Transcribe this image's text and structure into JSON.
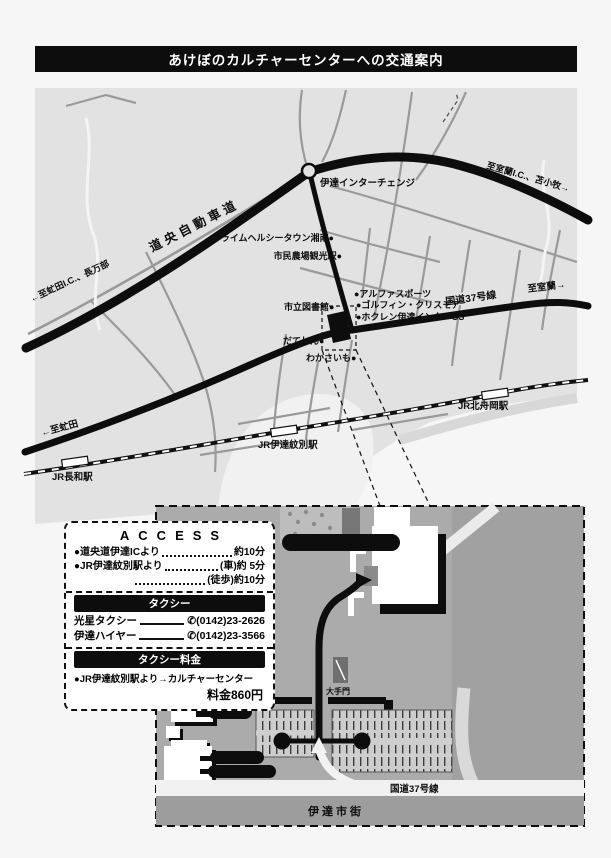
{
  "title": "あけぼのカルチャーセンターへの交通案内",
  "icons": {
    "phone": "✆",
    "parking": "P"
  },
  "map": {
    "expressway": "道央自動車道",
    "interchange": "伊達インターチェンジ",
    "to_muroran_ic": "至室蘭I.C.、苫小牧→",
    "to_abuta_ic": "←至虻田I.C.、長万部",
    "route37": "国道37号線",
    "to_muroran": "至室蘭→",
    "to_abuta": "←至虻田",
    "poi": {
      "prime_healthy_town": "プライムヘルシータウン湘南●",
      "shimin_station": "市民農場観光駅●",
      "alpha_sports": "●アルファスポーツ",
      "golfin_chrismore": "●ゴルフィン・クリスモア",
      "hokuren_gs": "●ホクレン伊達インターGS",
      "library": "市立図書館●",
      "dateshin": "だてしん●",
      "wakasaimo": "わかさいも●"
    },
    "stations": {
      "nagawa": "JR長和駅",
      "date_mombetsu": "JR伊達紋別駅",
      "kita_funaoka": "JR北舟岡駅"
    }
  },
  "access": {
    "title": "ACCESS",
    "rows": [
      {
        "label": "●道央道伊達ICより",
        "value": "約10分"
      },
      {
        "label": "●JR伊達紋別駅より",
        "value": "(車)約 5分"
      },
      {
        "label": "",
        "value": "(徒歩)約10分"
      }
    ],
    "taxi_header": "タクシー",
    "taxi_rows": [
      {
        "name": "光星タクシー",
        "phone": "(0142)23-2626"
      },
      {
        "name": "伊達ハイヤー",
        "phone": "(0142)23-3566"
      }
    ],
    "fare_header": "タクシー料金",
    "fare_route": "●JR伊達紋別駅より→カルチャーセンター",
    "fare_value": "料金860円"
  },
  "inset": {
    "culture_center": "カルチャーセンター",
    "otemon": "大手門",
    "city_hall": "市役所",
    "bocca": "Bocca",
    "bikkuri_donkey": "びっくりドンキー",
    "route37": "国道37号線",
    "city_area": "伊達市街",
    "parking": "P"
  },
  "colors": {
    "banner": "#0d0d0d",
    "land": "#e2e2e2",
    "road_black": "#0d0d0d",
    "road_gray": "#999999",
    "inset_bg": "#ababab",
    "white": "#ffffff"
  }
}
